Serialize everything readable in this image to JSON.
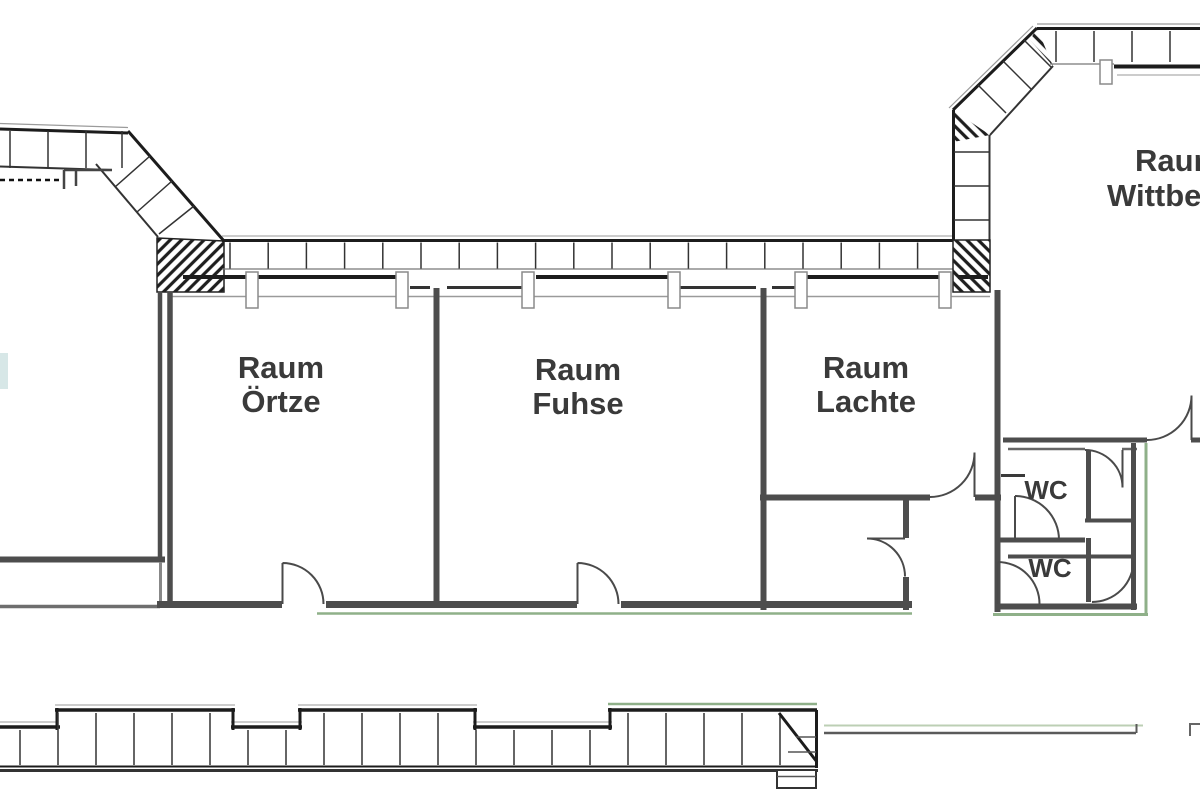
{
  "plan": {
    "rooms": [
      {
        "line1": "Raum",
        "line2": "Örtze"
      },
      {
        "line1": "Raum",
        "line2": "Fuhse"
      },
      {
        "line1": "Raum",
        "line2": "Lachte"
      },
      {
        "line1": "Raum",
        "line2": "Wittbec"
      }
    ],
    "wc_labels": [
      "WC",
      "WC"
    ]
  },
  "colors": {
    "background": "#ffffff",
    "wall": "#4d4d4d",
    "band": "#1c1c1c",
    "thin": "#9a9a9a",
    "door": "#4a4a4a",
    "accent_green": "#8fb089",
    "accent_green_light": "#bccfb4",
    "text": "#3a3a3a",
    "teal_fragment": "#d7e7e7"
  }
}
